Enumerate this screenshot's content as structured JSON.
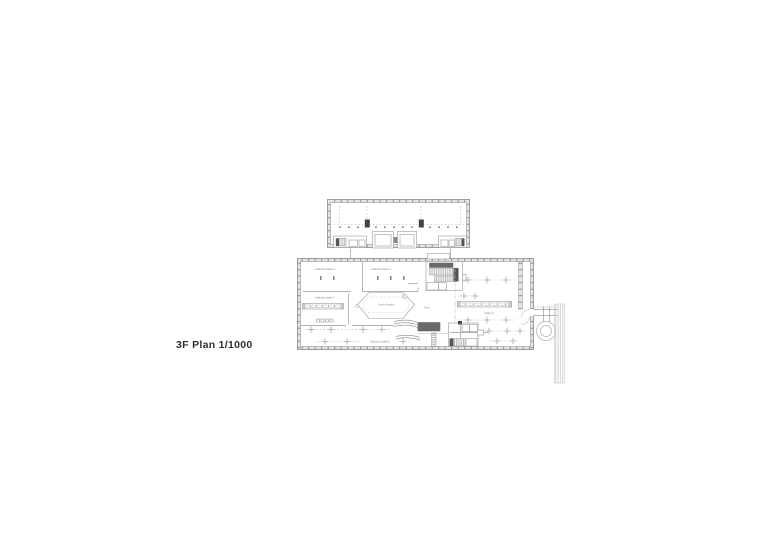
{
  "caption": {
    "text": "3F Plan 1/1000",
    "floor": "3F",
    "scale": "1/1000"
  },
  "drawing": {
    "room_labels": {
      "gallery3": "Collection Gallery 3",
      "gallery1": "Collection Gallery 1",
      "gallery2": "Collection Gallery 2",
      "garden": "Sunken Garden",
      "foyer": "Foyer",
      "gallery4": "Gallery 4",
      "gallery5": "Collection Gallery 5"
    },
    "colors": {
      "background": "#ffffff",
      "line": "#9a9a9a",
      "wall_fill": "#e4e4e4",
      "dark_fill": "#434343",
      "caption_text": "#2f2f2f",
      "label_text": "#828282"
    }
  }
}
